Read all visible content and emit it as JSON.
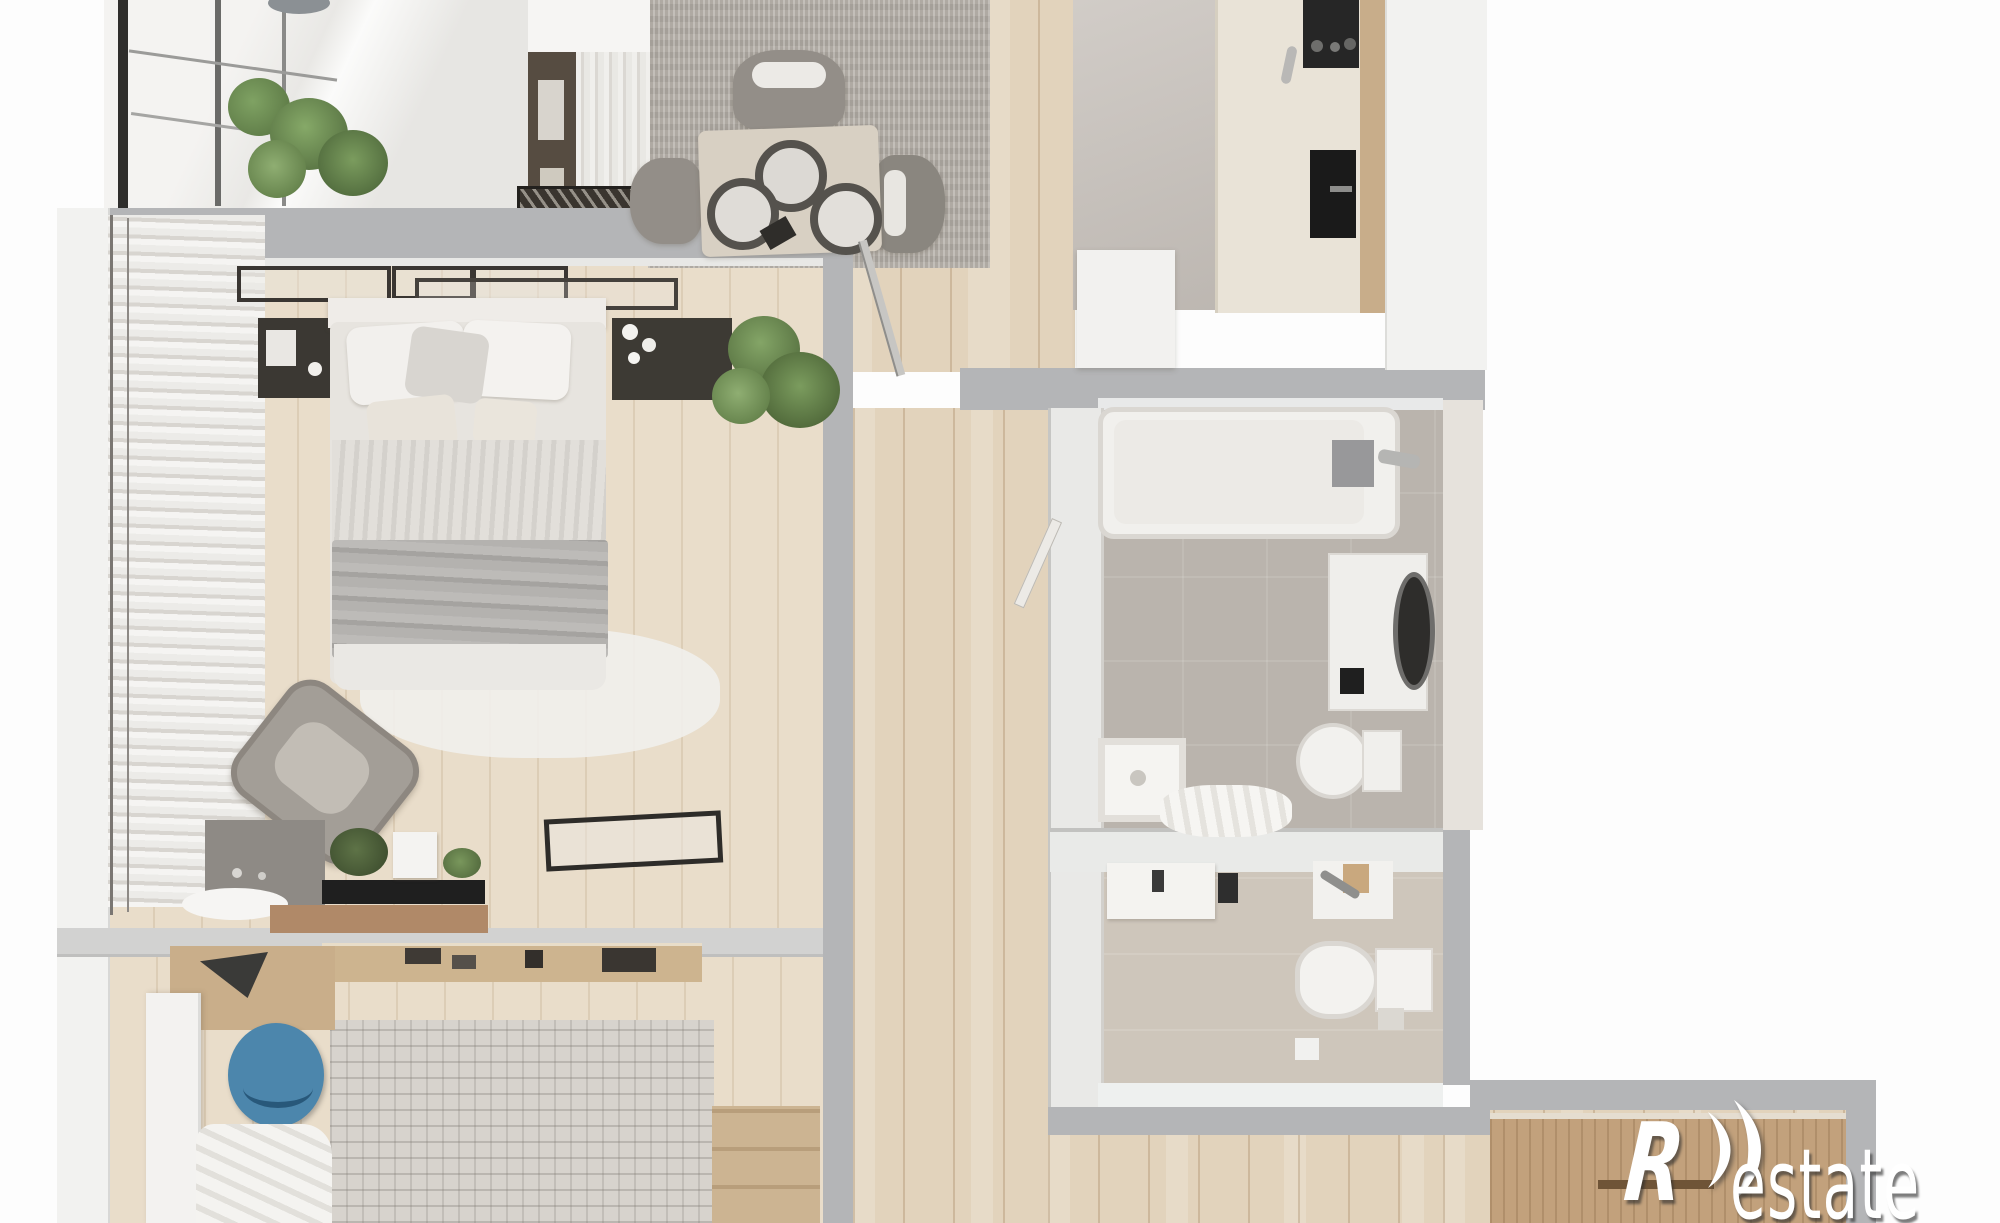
{
  "watermark": {
    "brand": "Restate",
    "r": "R",
    "suffix": "estate",
    "logo": "double-crescent-r-logo"
  },
  "colors": {
    "margin-white": "#fdfdfd",
    "wall-gray": "#b4b5b7",
    "wall-white": "#f2f2f0",
    "wood-floor": "#e2d3bc",
    "bedroom-floor": "#e9ddca",
    "kitchen-tile": "#c7c1bb",
    "bath-tile": "#bab4ad",
    "wc-tile": "#cec6bb",
    "dining-rug": "#b3ada6",
    "rug2": "#d7d3cd",
    "counter-cream": "#e9e3d7",
    "appliance-black": "#262626",
    "fixture-white": "#f2f1ee",
    "duvet-gray": "#b4b2af",
    "pillow-white": "#f2f0ed",
    "chair-gray": "#938e88",
    "chair-blue": "#4c86ac",
    "plant-green": "#6a8a52",
    "plant-dark": "#44503a",
    "furniture-dark": "#3a352f",
    "cabinet-wood": "#c2a17c",
    "shelf-wood": "#cdb48f",
    "watermark-white": "#ffffff"
  }
}
